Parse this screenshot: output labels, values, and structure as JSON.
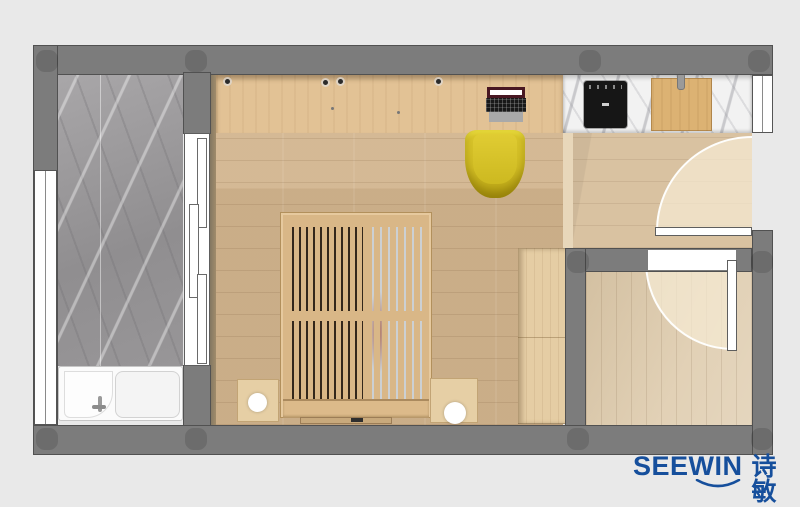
{
  "brand": {
    "name": "SEEWIN",
    "name_cn": "诗敏"
  },
  "icons": {
    "logo_swoosh": "smile-arc-under-logo"
  },
  "palette": {
    "background": "#e9e9e9",
    "wall": "#7c7c7c",
    "wall_edge": "#4a4a4a",
    "floor_wood": "#d1b38c",
    "desk_wood": "#e2c295",
    "hall_wood": "#d9c2a1",
    "room_wood": "#dcc8a8",
    "bed_wood": "#d9b787",
    "wardrobe_wood": "#e5cda4",
    "marble_gray": "#9e9c9e",
    "marble_white": "#f2f2f2",
    "chair_yellow": "#d2bd24",
    "appliance_black": "#161616",
    "door_white": "#ffffff",
    "logo_blue": "#164f9c"
  }
}
